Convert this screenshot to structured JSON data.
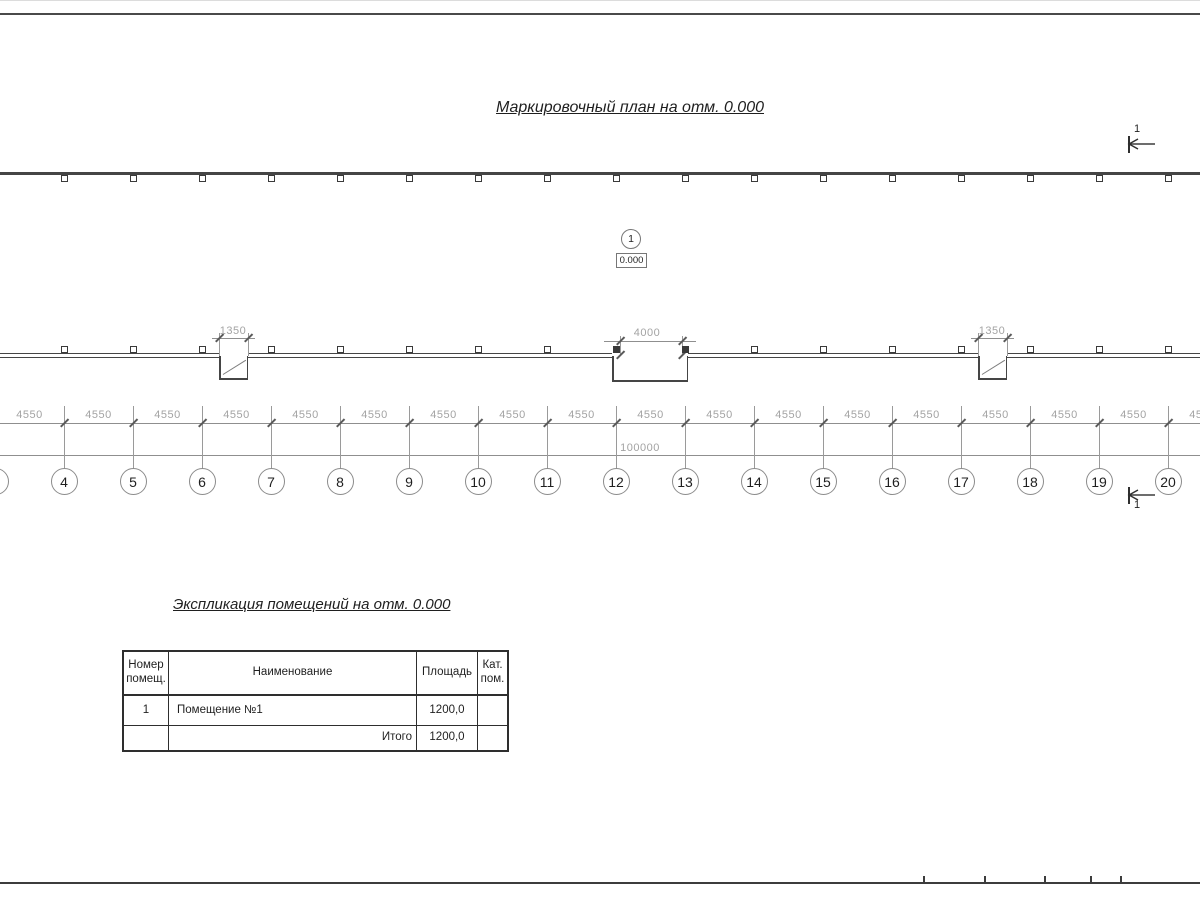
{
  "titles": {
    "plan_title": "Маркировочный план на отм. 0.000",
    "schedule_title": "Экспликация помещений на отм. 0.000"
  },
  "plan": {
    "room_tag": {
      "number": "1",
      "elevation": "0.000"
    },
    "section_marks": {
      "top_label": "1",
      "bottom_label": "1"
    },
    "openings": [
      {
        "width_label": "1350"
      },
      {
        "width_label": "4000"
      },
      {
        "width_label": "1350"
      }
    ],
    "dimensions": {
      "bay_spacing": "4550",
      "overall_length": "100000"
    },
    "grid_axis_labels": [
      "4",
      "5",
      "6",
      "7",
      "8",
      "9",
      "10",
      "11",
      "12",
      "13",
      "14",
      "15",
      "16",
      "17",
      "18",
      "19",
      "20"
    ]
  },
  "schedule": {
    "headers": {
      "number": "Номер\nпомещ.",
      "name": "Наименование",
      "area": "Площадь",
      "category": "Кат.\nпом."
    },
    "rows": [
      {
        "number": "1",
        "name": "Помещение №1",
        "area": "1200,0",
        "category": ""
      }
    ],
    "total": {
      "label": "Итого",
      "area": "1200,0",
      "category": ""
    }
  }
}
